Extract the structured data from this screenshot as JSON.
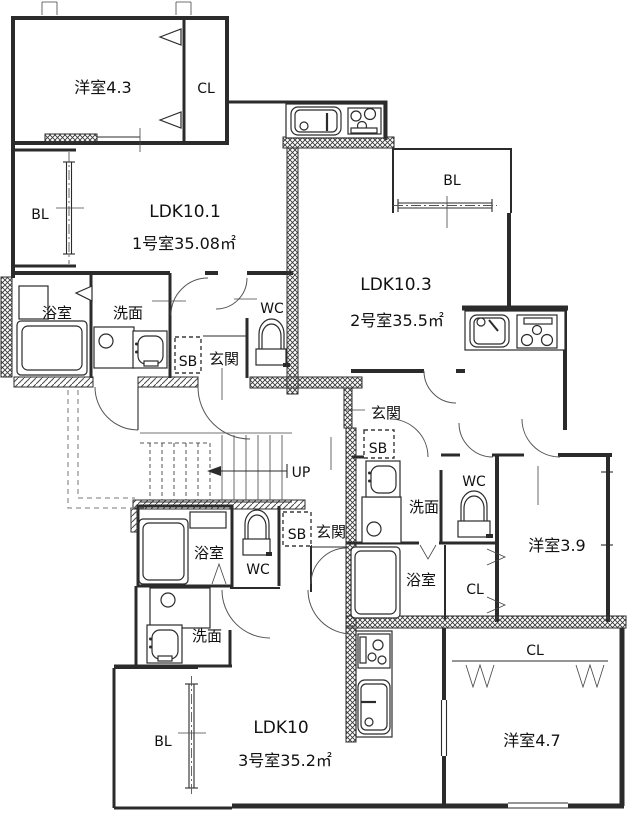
{
  "floor_plan": {
    "type": "apartment-floor-plan",
    "stairs": {
      "direction_label": "UP"
    },
    "colors": {
      "line": "#2b2b2b",
      "background": "#ffffff"
    },
    "units": [
      {
        "id": "1",
        "ldk_label": "LDK10.1",
        "area_label": "1号室35.08㎡",
        "rooms": {
          "bedroom": "洋室4.3",
          "closet": "CL",
          "balcony": "BL",
          "bath": "浴室",
          "washroom": "洗面",
          "toilet": "WC",
          "shoebox": "SB",
          "entrance": "玄関"
        }
      },
      {
        "id": "2",
        "ldk_label": "LDK10.3",
        "area_label": "2号室35.5㎡",
        "rooms": {
          "balcony": "BL",
          "entrance": "玄関",
          "shoebox": "SB",
          "washroom": "洗面",
          "toilet": "WC",
          "bath": "浴室",
          "closet": "CL",
          "bedroom": "洋室3.9"
        }
      },
      {
        "id": "3",
        "ldk_label": "LDK10",
        "area_label": "3号室35.2㎡",
        "rooms": {
          "bath": "浴室",
          "toilet": "WC",
          "shoebox": "SB",
          "entrance": "玄関",
          "washroom": "洗面",
          "balcony": "BL",
          "closet": "CL",
          "bedroom": "洋室4.7"
        }
      }
    ]
  }
}
